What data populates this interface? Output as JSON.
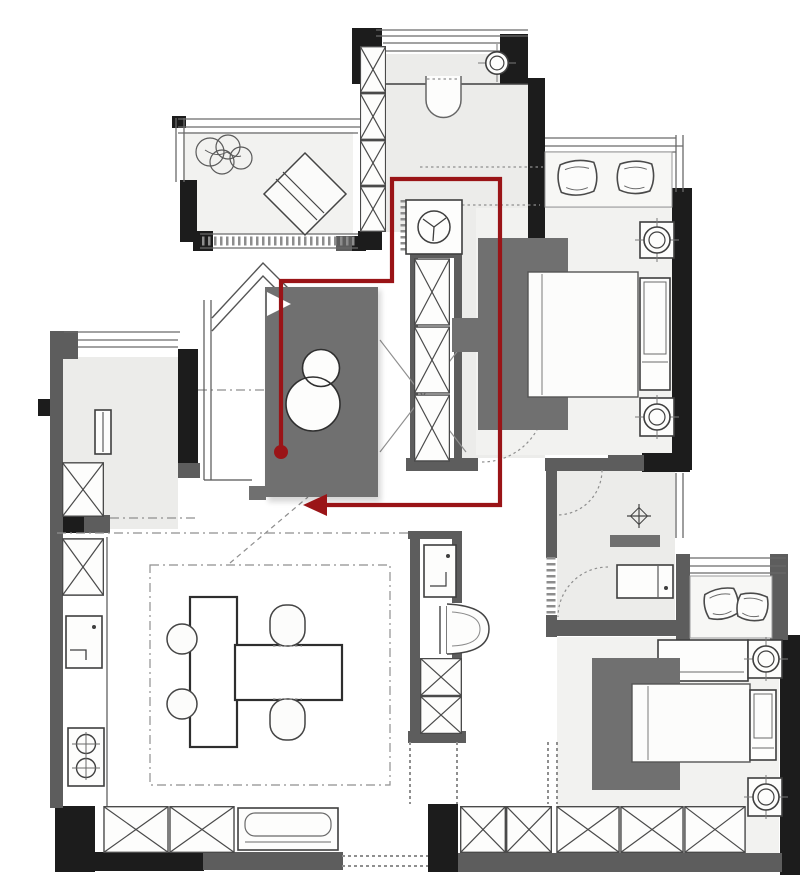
{
  "route": {
    "polyline_points": "281,452 281,281 392,281 392,179 500,179 500,505 327,505",
    "dot": {
      "cx": "281",
      "cy": "452",
      "r": "7"
    },
    "arrow_points": "303,505 327,494 327,516"
  },
  "colors": {
    "wall": "#1c1c1c",
    "wallgray": "#5d5d5d",
    "gray": "#707070",
    "line": "#3f3f3f",
    "window": "#6a6a6a",
    "guide": "#8f8f8f",
    "red": "#9a1417",
    "floor-tint": "#f2f2f0",
    "paper": "#ffffff"
  }
}
